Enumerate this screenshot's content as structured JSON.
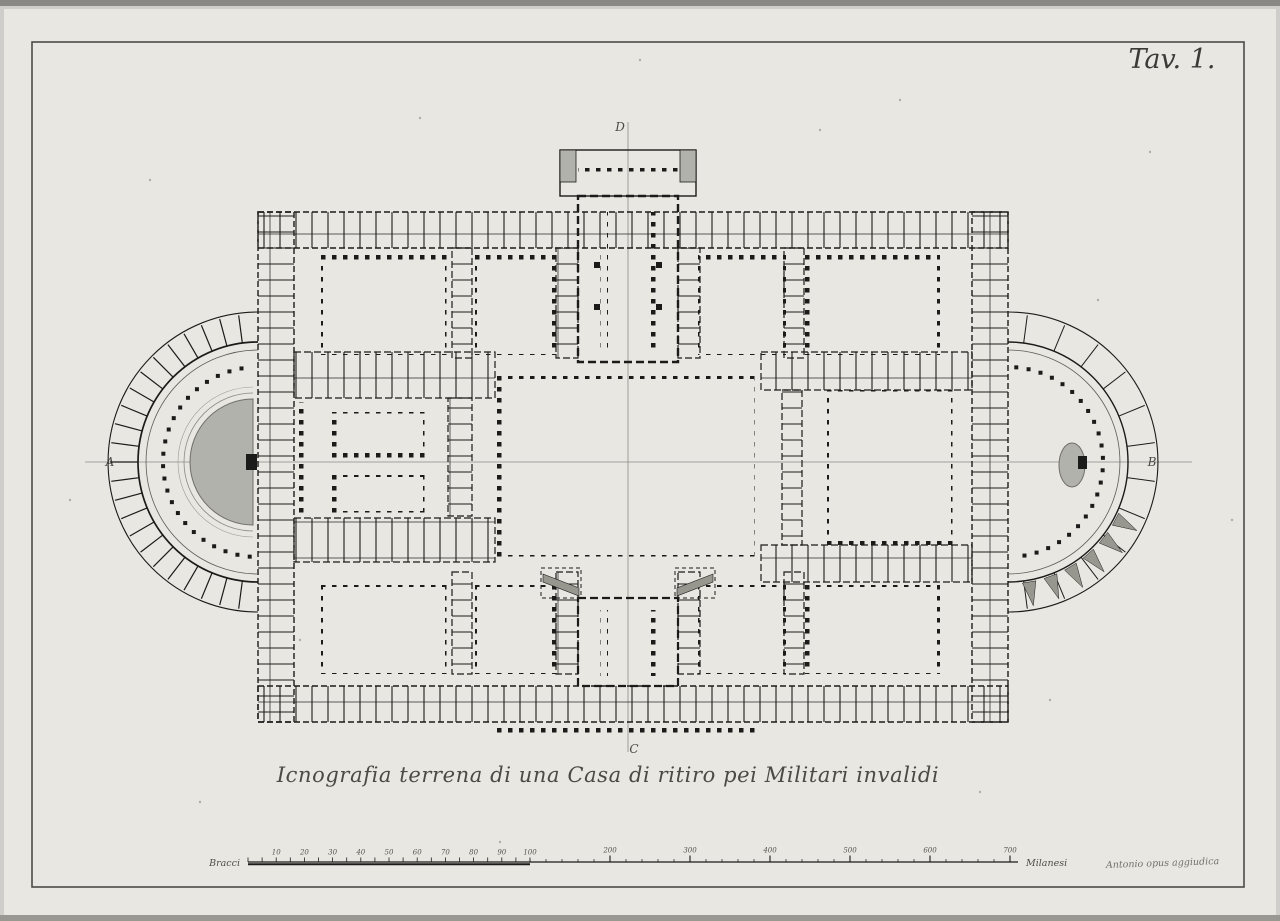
{
  "sheet": {
    "plate_label": "Tav. 1.",
    "caption": "Icnografia terrena di una Casa di ritiro pei Militari invalidi",
    "signature": "Antonio opus aggiudica",
    "colors": {
      "paper": "#e9e7e2",
      "margin": "#d2d1cd",
      "ink": "#1b1b19",
      "shade": "#b2b2ac",
      "faint": "#8c8b86"
    }
  },
  "plan": {
    "axis_labels": {
      "left": "A",
      "right": "B",
      "top": "D",
      "bottom": "C"
    }
  },
  "scalebar": {
    "unit_left": "Bracci",
    "unit_right": "Milanesi",
    "minor_labels": [
      "10",
      "20",
      "30",
      "40",
      "50",
      "60",
      "70",
      "80",
      "90",
      "100"
    ],
    "major_labels": [
      "200",
      "300",
      "400",
      "500",
      "600",
      "700"
    ]
  }
}
